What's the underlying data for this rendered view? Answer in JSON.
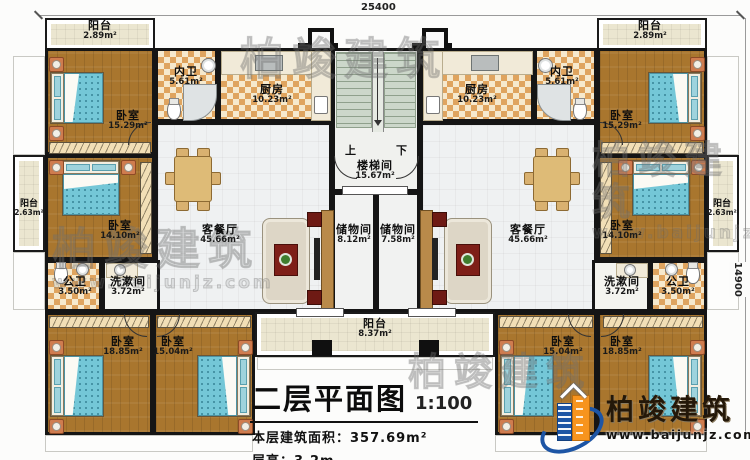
{
  "dimensions": {
    "top": "25400",
    "right": "14900"
  },
  "stairs": {
    "up": "上",
    "down": "下"
  },
  "rooms": {
    "balcony_top_left": {
      "name": "阳台",
      "area": "2.89m²"
    },
    "balcony_top_right": {
      "name": "阳台",
      "area": "2.89m²"
    },
    "bedroom_top_left": {
      "name": "卧室",
      "area": "15.29m²"
    },
    "bedroom_top_right": {
      "name": "卧室",
      "area": "15.29m²"
    },
    "bath_inner_left": {
      "name": "内卫",
      "area": "5.61m²"
    },
    "bath_inner_right": {
      "name": "内卫",
      "area": "5.61m²"
    },
    "kitchen_left": {
      "name": "厨房",
      "area": "10.23m²"
    },
    "kitchen_right": {
      "name": "厨房",
      "area": "10.23m²"
    },
    "stairwell": {
      "name": "楼梯间",
      "area": "15.67m²"
    },
    "balcony_left": {
      "name": "阳台",
      "area": "2.63m²"
    },
    "balcony_right": {
      "name": "阳台",
      "area": "2.63m²"
    },
    "bedroom_mid_left": {
      "name": "卧室",
      "area": "14.10m²"
    },
    "bedroom_mid_right": {
      "name": "卧室",
      "area": "14.10m²"
    },
    "living_left": {
      "name": "客餐厅",
      "area": "45.66m²"
    },
    "living_right": {
      "name": "客餐厅",
      "area": "45.66m²"
    },
    "storage_left": {
      "name": "储物间",
      "area": "8.12m²"
    },
    "storage_right": {
      "name": "储物间",
      "area": "7.58m²"
    },
    "toilet_left": {
      "name": "公卫",
      "area": "3.50m²"
    },
    "toilet_right": {
      "name": "公卫",
      "area": "3.50m²"
    },
    "wash_left": {
      "name": "洗漱间",
      "area": "3.72m²"
    },
    "wash_right": {
      "name": "洗漱间",
      "area": "3.72m²"
    },
    "bedroom_bottom_left_outer": {
      "name": "卧室",
      "area": "18.85m²"
    },
    "bedroom_bottom_left_inner": {
      "name": "卧室",
      "area": "15.04m²"
    },
    "bedroom_bottom_right_inner": {
      "name": "卧室",
      "area": "15.04m²"
    },
    "bedroom_bottom_right_outer": {
      "name": "卧室",
      "area": "18.85m²"
    },
    "balcony_bottom": {
      "name": "阳台",
      "area": "8.37m²"
    }
  },
  "title_block": {
    "title": "二层平面图",
    "scale": "1:100",
    "area_line": "本层建筑面积：357.69m²",
    "height_line": "层高：3.2m"
  },
  "logo": {
    "name": "柏竣建筑",
    "url": "www.baijunjz.com"
  },
  "watermark": {
    "text": "柏竣建筑",
    "url": "www.baijunjz.com"
  },
  "colors": {
    "wall": "#151515",
    "wood_floor": "#a9762e",
    "tile": "#dfa45f",
    "balcony": "#ebe6d0",
    "stair": "#ccd7ca",
    "bed": "#74c7d7",
    "logo_blue": "#1d55a5",
    "logo_orange": "#f7941e"
  }
}
